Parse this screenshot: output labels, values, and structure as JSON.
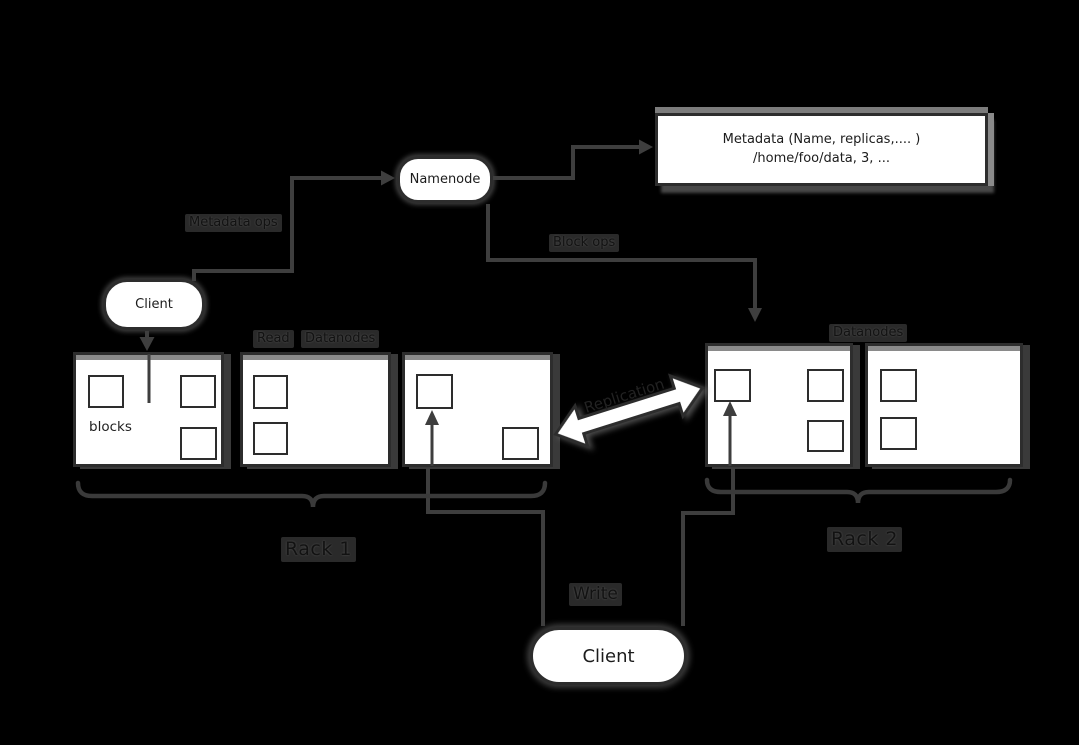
{
  "diagram": {
    "nodes": {
      "namenode": {
        "label": "Namenode"
      },
      "client_top": {
        "label": "Client"
      },
      "client_bottom": {
        "label": "Client"
      },
      "metadata": {
        "line1": "Metadata (Name, replicas,.... )",
        "line2": "/home/foo/data, 3, ..."
      }
    },
    "labels": {
      "metadata_ops": "Metadata ops",
      "block_ops": "Block ops",
      "read": "Read",
      "datanodes_rack1": "Datanodes",
      "datanodes_rack2": "Datanodes",
      "blocks": "blocks",
      "replication": "Replication",
      "write": "Write",
      "rack1": "Rack 1",
      "rack2": "Rack 2"
    },
    "racks": {
      "rack1": {
        "label": "Rack 1",
        "datanode_count": 3,
        "blocks_per_datanode": [
          3,
          2,
          2
        ]
      },
      "rack2": {
        "label": "Rack 2",
        "datanode_count": 2,
        "blocks_per_datanode": [
          3,
          2
        ]
      }
    },
    "colors": {
      "background": "#000000",
      "node_fill": "#ffffff",
      "line": "#3e3e3e",
      "border": "#2d2d2d",
      "text": "#1a1a1a",
      "shadow": "#8a8a8a"
    }
  }
}
